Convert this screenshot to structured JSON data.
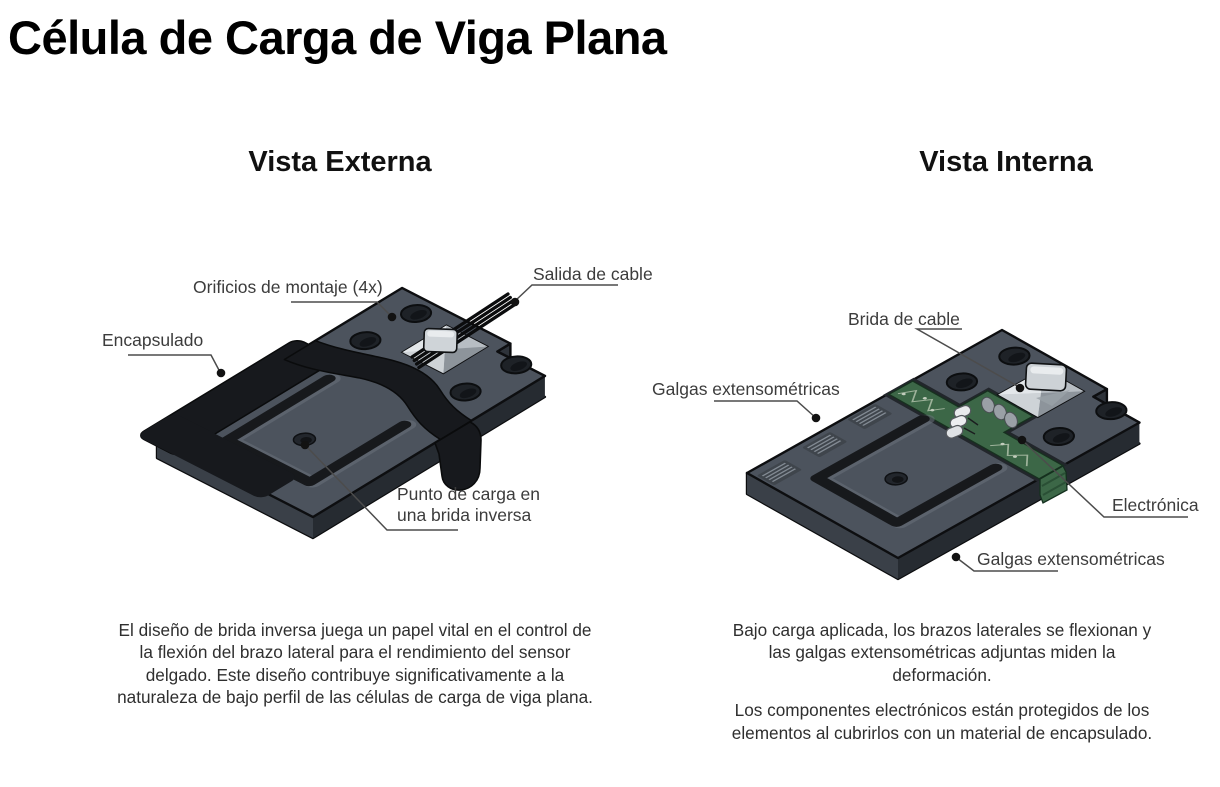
{
  "title": "Célula de Carga de Viga Plana",
  "colors": {
    "background": "#ffffff",
    "plate_top": "#4c535d",
    "plate_side": "#2e333a",
    "encapsulation": "#17191d",
    "pcb_green": "#3c6747",
    "clamp_gray": "#c6cbd0",
    "leader_line": "#4c4c4c",
    "label_text": "#3c3c3c"
  },
  "external": {
    "heading": "Vista Externa",
    "labels": {
      "mounting_holes": "Orificios de montaje (4x)",
      "cable_exit": "Salida de cable",
      "encapsulation": "Encapsulado",
      "load_point": "Punto de carga en una brida inversa"
    },
    "description": "El diseño de brida inversa juega un papel vital en el control de la flexión del brazo lateral para el rendimiento del sensor delgado. Este diseño contribuye significativamente a la naturaleza de bajo perfil de las células de carga de viga plana."
  },
  "internal": {
    "heading": "Vista Interna",
    "labels": {
      "cable_clamp": "Brida de cable",
      "strain_gauges_left": "Galgas extensométricas",
      "electronics": "Electrónica",
      "strain_gauges_bottom": "Galgas extensométricas"
    },
    "descriptions": {
      "p1": "Bajo carga aplicada, los brazos laterales se flexionan y las galgas extensométricas adjuntas miden la deformación.",
      "p2": "Los componentes electrónicos están protegidos de los elementos al cubrirlos con un material de encapsulado."
    }
  }
}
